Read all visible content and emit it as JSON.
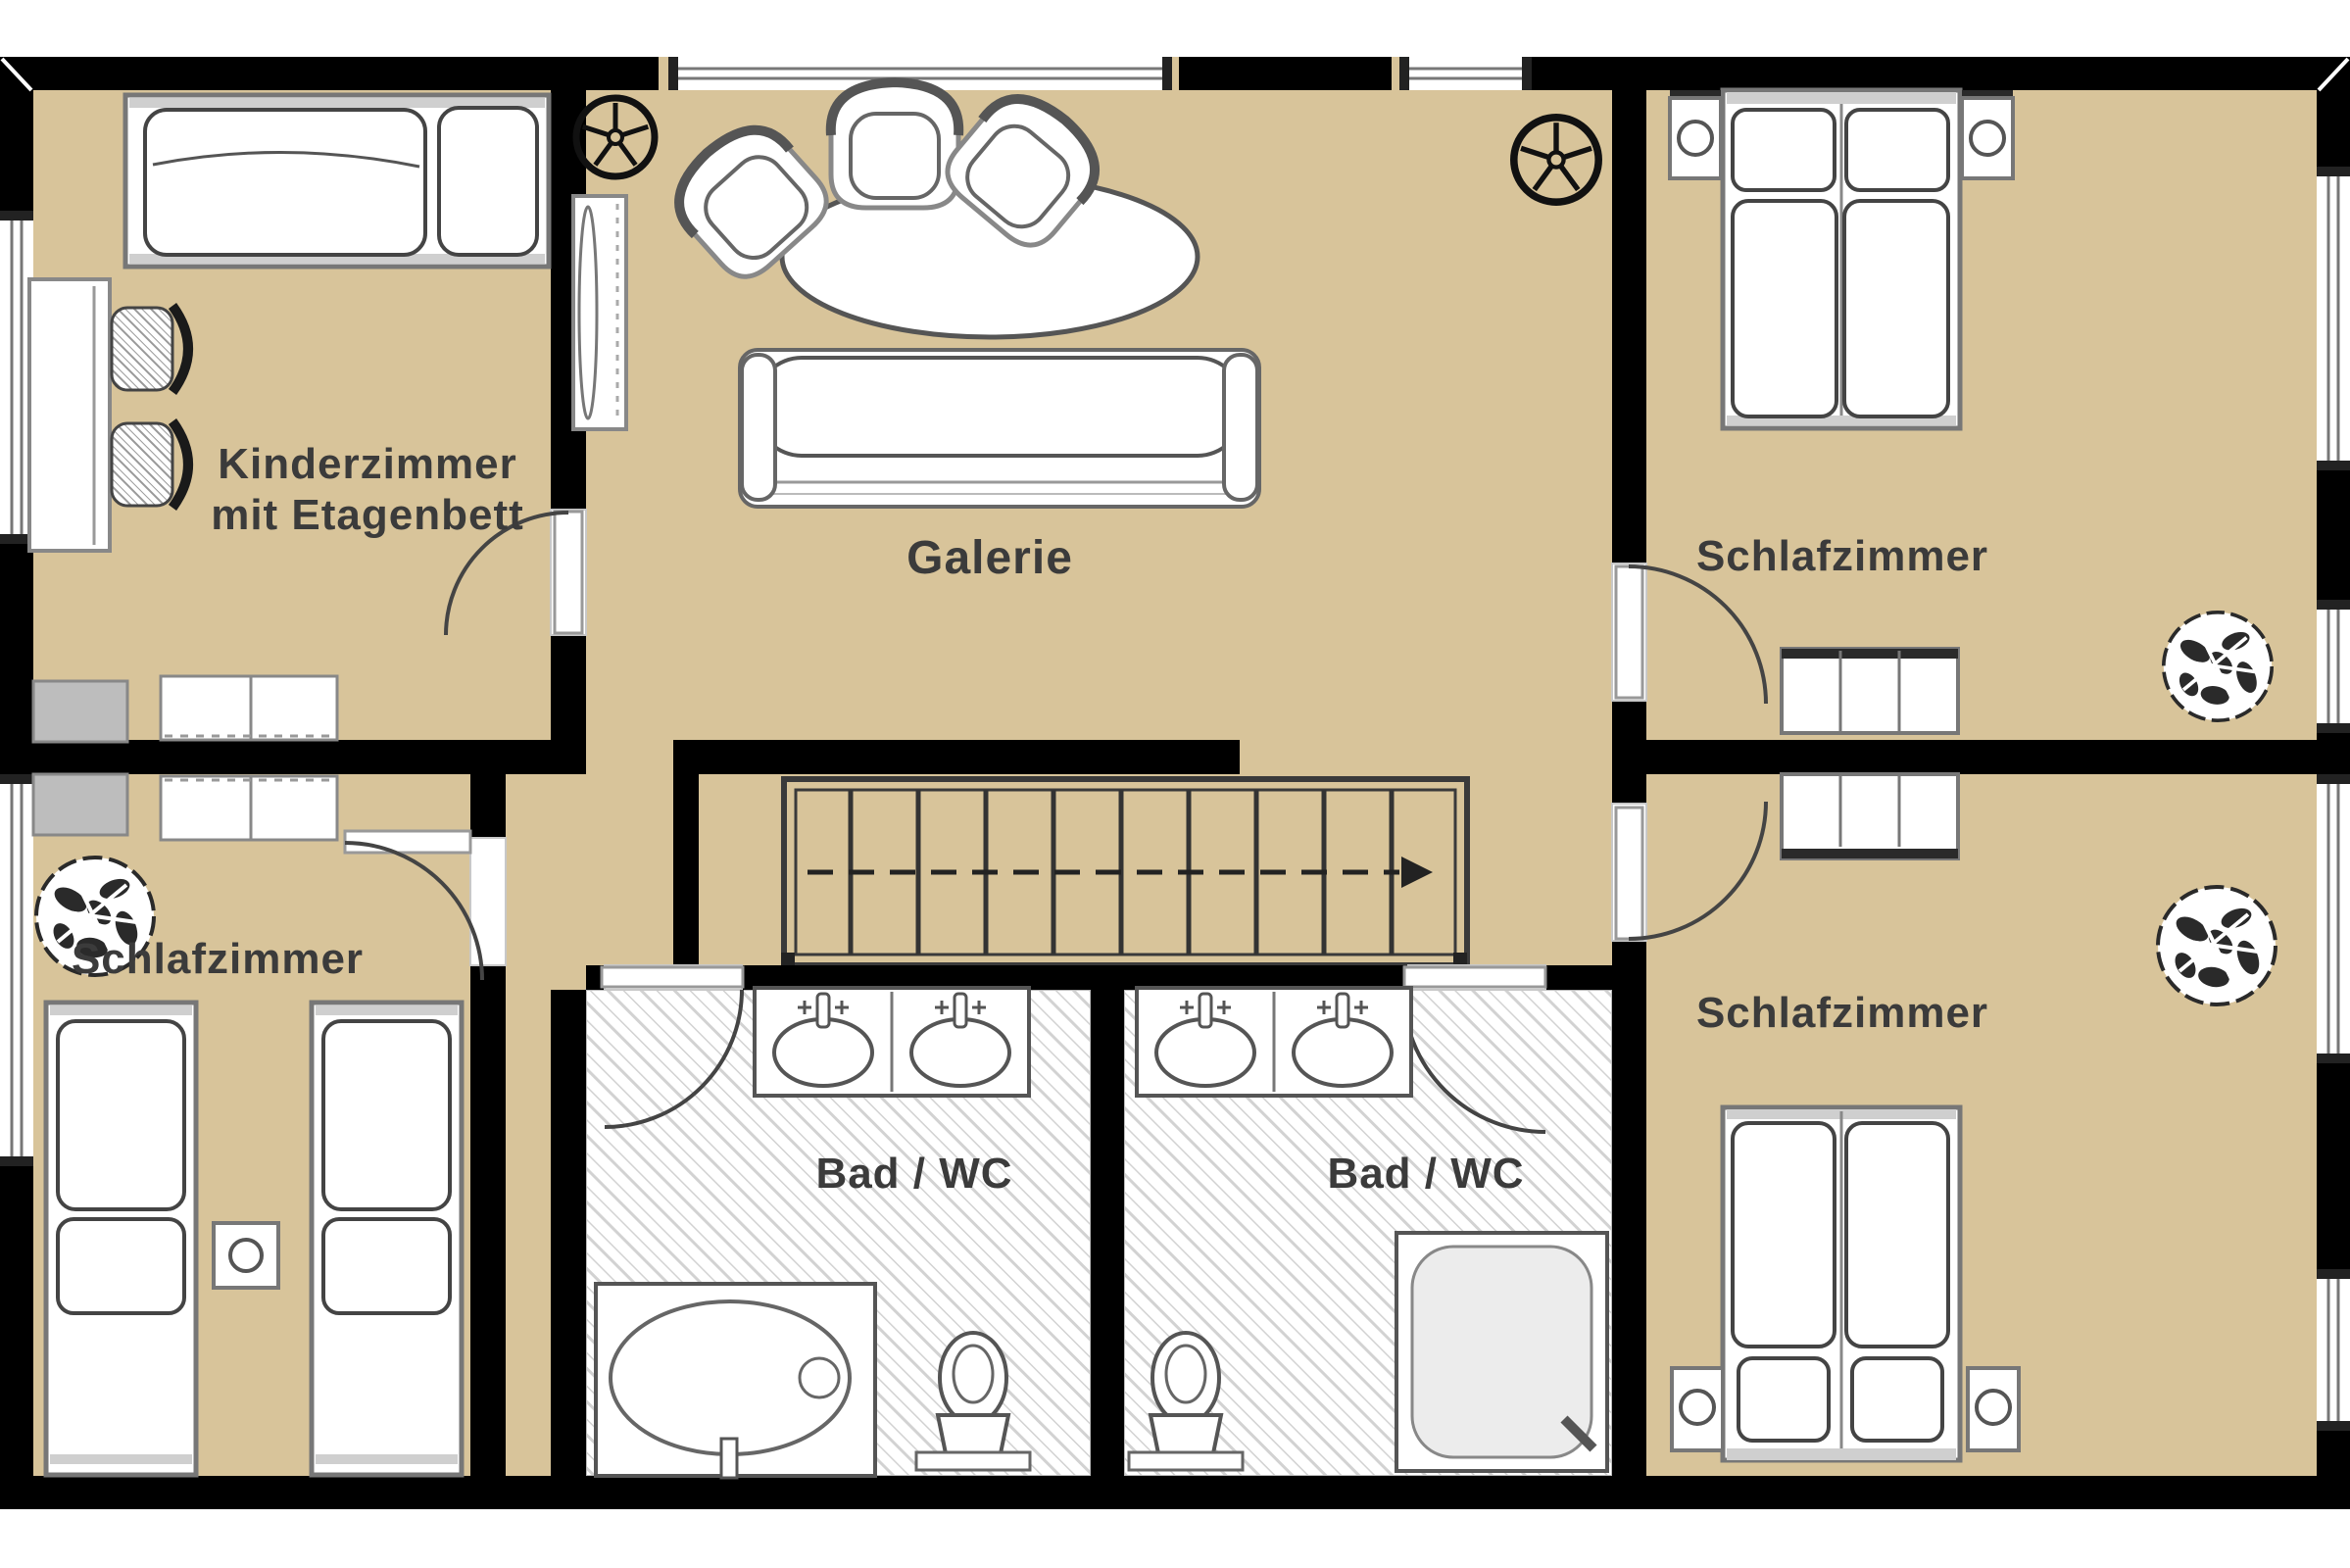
{
  "plan": {
    "type": "apartment-upper-floor-plan",
    "floor_color": "#d8c49a",
    "wall_color": "#000000",
    "bath_floor_color": "#ffffff",
    "bath_hatch_color": "#d2d2d2",
    "furniture_outline_color": "#666666",
    "label_color": "#3b3b3b"
  },
  "rooms": [
    {
      "name": "kinderzimmer",
      "label": "Kinderzimmer",
      "sublabel": "mit Etagenbett"
    },
    {
      "name": "galerie",
      "label": "Galerie"
    },
    {
      "name": "schlafzimmer-top-right",
      "label": "Schlafzimmer"
    },
    {
      "name": "schlafzimmer-bottom-left",
      "label": "Schlafzimmer"
    },
    {
      "name": "schlafzimmer-bottom-right",
      "label": "Schlafzimmer"
    },
    {
      "name": "bad-wc-left",
      "label": "Bad / WC"
    },
    {
      "name": "bad-wc-right",
      "label": "Bad / WC"
    }
  ],
  "icons": {
    "fan": "ceiling-fan-icon",
    "plant": "plant-icon",
    "stairs": "staircase-icon",
    "arrow": "stair-direction-arrow-icon"
  }
}
